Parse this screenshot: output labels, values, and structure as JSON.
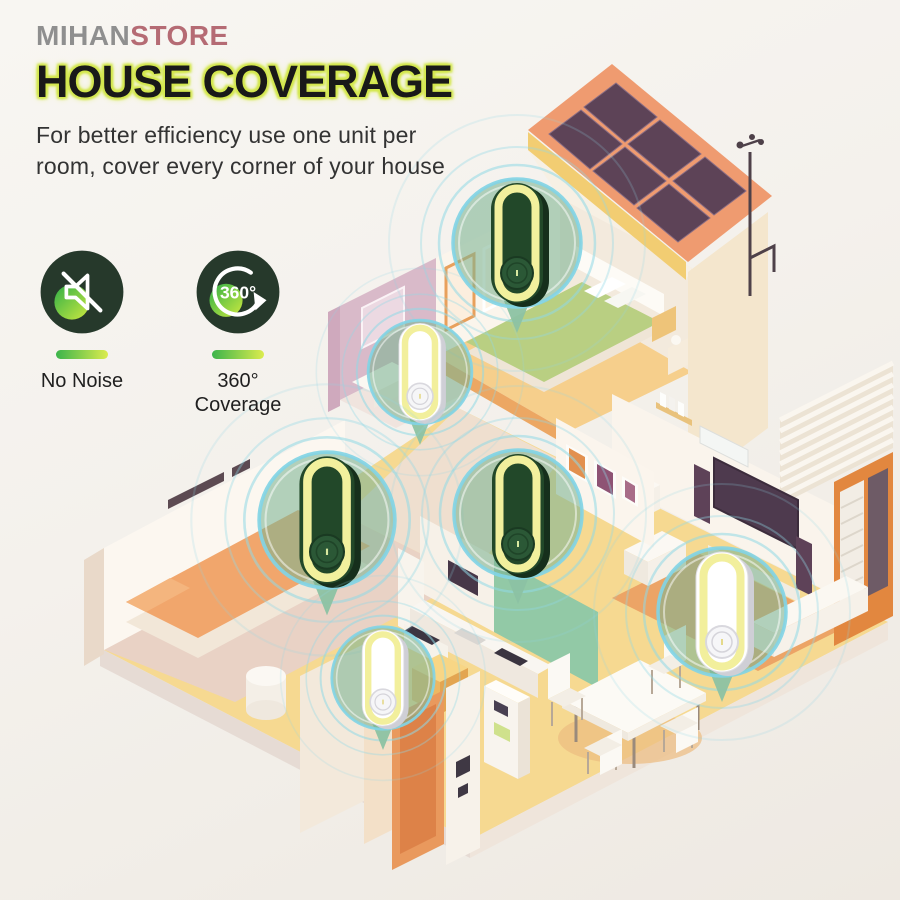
{
  "brand": {
    "part1": "MIHAN",
    "part2": "STORE"
  },
  "header": {
    "title": "HOUSE COVERAGE",
    "subtitle_line1": "For better efficiency use one unit per",
    "subtitle_line2": "room, cover every corner of your house"
  },
  "features": [
    {
      "id": "no-noise",
      "icon": "muted-speaker-icon",
      "label_line1": "No Noise",
      "label_line2": ""
    },
    {
      "id": "360-coverage",
      "icon": "rotation-arrow-icon",
      "badge": "360°",
      "label_line1": "360°",
      "label_line2": "Coverage"
    }
  ],
  "illustration": {
    "description": "Isometric cutaway house with solar roof; one ultrasonic repeller unit per room shown in teal callout bubbles",
    "device_count": 6,
    "devices": [
      {
        "room": "upstairs-bedroom",
        "variant": "green",
        "transform": "translate(517,243)",
        "variant_class": "dev-green"
      },
      {
        "room": "upstairs-bathroom",
        "variant": "white",
        "transform": "translate(420,372) scale(0.81)",
        "variant_class": "dev-white"
      },
      {
        "room": "bedroom",
        "variant": "green",
        "transform": "translate(327,520) scale(1.06)",
        "variant_class": "dev-green"
      },
      {
        "room": "hallway-kitchen",
        "variant": "green",
        "transform": "translate(518,514)",
        "variant_class": "dev-green"
      },
      {
        "room": "downstairs-bathroom",
        "variant": "white",
        "transform": "translate(383,678) scale(0.80)",
        "variant_class": "dev-white"
      },
      {
        "room": "living-room",
        "variant": "white",
        "transform": "translate(722,612)",
        "variant_class": "dev-white"
      }
    ],
    "rooms": [
      "upstairs bedroom",
      "upstairs bathroom",
      "bedroom",
      "hallway / kitchen",
      "downstairs bathroom",
      "living room"
    ]
  },
  "colors": {
    "title_glow": "#d3e74d",
    "brand_gray": "#8f8f8f",
    "brand_rose": "#b56b74",
    "icon_circle": "#26392b",
    "icon_gradient": [
      "#2fae48",
      "#cdea3f"
    ],
    "bubble_fill": "#7cb493",
    "bubble_ring": "#82d4e5",
    "device_ring_yellow": "#f2f09d",
    "device_green": "#224829",
    "roof_salmon": "#ef9b70",
    "solar_panel": "#5d4357",
    "floor_yellow": "#f6d991"
  }
}
